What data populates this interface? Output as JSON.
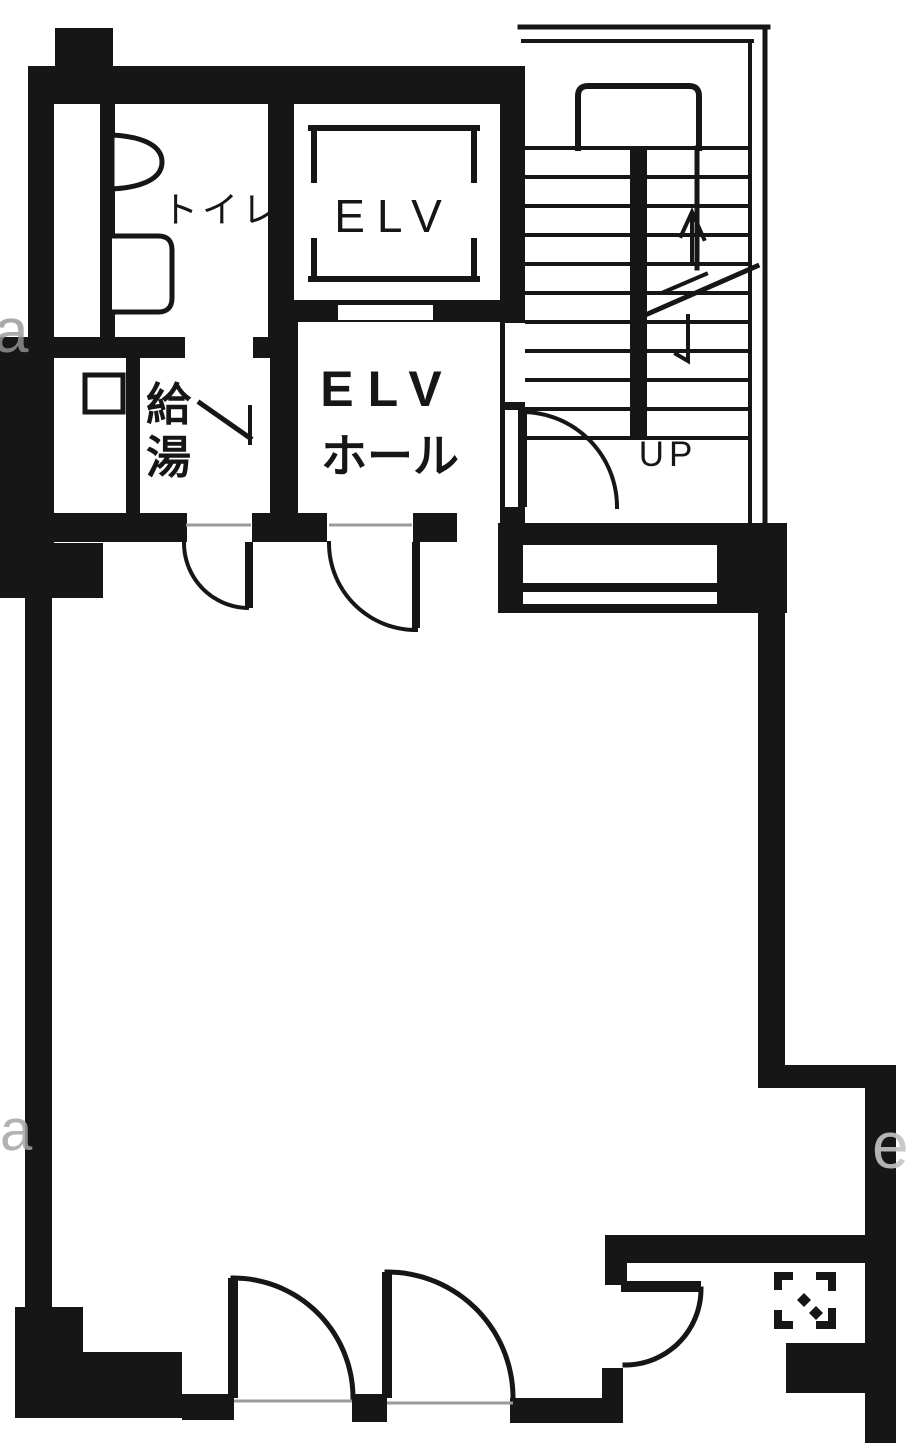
{
  "title": "building-floor-plan",
  "labels": {
    "toilet": "トイレ",
    "elevator_shaft": "ELV",
    "elevator_hall_line1": "ELV",
    "elevator_hall_line2": "ホール",
    "hot_water_char1": "給",
    "hot_water_char2": "湯",
    "stairs_up": "UP"
  },
  "watermark": {
    "left_upper": "a",
    "left_lower": "a",
    "right_lower": "e"
  },
  "colors": {
    "ink": "#161616",
    "paper": "#ffffff",
    "watermark": "#a5a5a5",
    "threshold": "#9a9a9a"
  }
}
